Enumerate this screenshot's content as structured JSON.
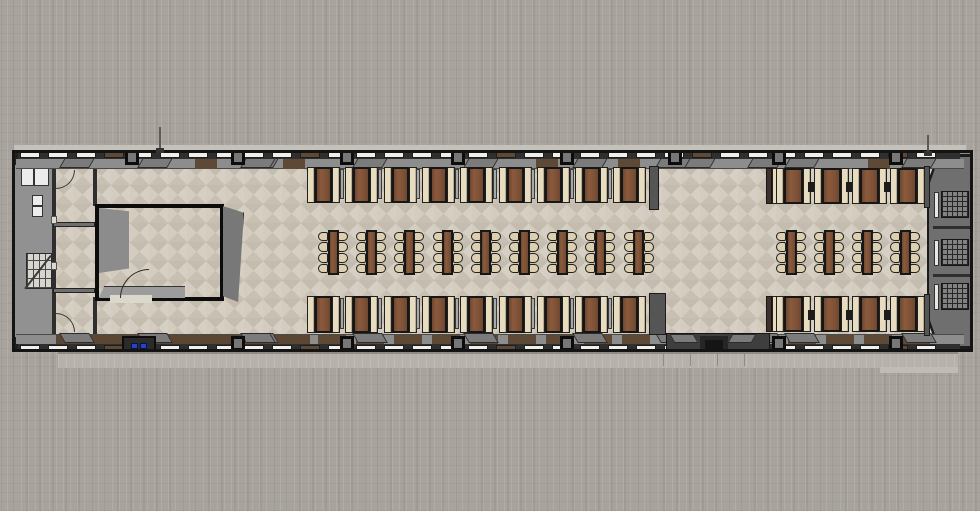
{
  "meta": {
    "width": 980,
    "height": 511,
    "scene": "top-down 3d floor plan render of a long railcar-style dining hall"
  },
  "colors": {
    "background": "#a8a49d",
    "platform": "#b6b2ab",
    "floor_light": "#d6d0c4",
    "floor_dark": "#c6bfb1",
    "wall_gray": "#8d8d8d",
    "wall_dark": "#2f2f2f",
    "frame_black": "#141414",
    "window_white": "#f1efe9",
    "wood_wall": "#5d4936",
    "table_brown": "#7e5237",
    "bench_cream": "#e7dcc0",
    "chair_cream": "#dccfb2",
    "left_cap_gray": "#919191",
    "right_cap_gray": "#6f6f6f",
    "stub_gray": "#555555",
    "trapezoid_gray": "#7b7b7b",
    "blue_fixture": "#2545c8",
    "roof_edge": "#c4c1ba"
  },
  "building": {
    "x": 12,
    "y": 150,
    "w": 961,
    "h": 202
  },
  "platform": {
    "x": 58,
    "y": 352,
    "w": 900,
    "h": 16,
    "tick_xs": [
      663,
      690,
      717,
      744
    ],
    "right_step": {
      "x": 880,
      "y": 367,
      "w": 78,
      "h": 6
    }
  },
  "floor": {
    "x": 54,
    "y": 166,
    "w": 878,
    "h": 170
  },
  "walls": {
    "window_row": {
      "start": 18,
      "end": 960,
      "step": 28,
      "seg_w": 20,
      "seg_h": 8,
      "top_y": 151,
      "bottom_y": 344,
      "brown_every": 7
    },
    "inner_band": {
      "top_y": 159,
      "bottom_y": 334,
      "h": 10
    },
    "boxes": {
      "xs": [
        125,
        231,
        340,
        451,
        560,
        668,
        772,
        889
      ],
      "w": 14,
      "h": 15,
      "top_y": 150,
      "bottom_y": 336
    },
    "trapezoid_extra_xs": [
      62,
      243,
      658,
      750
    ],
    "top_brown_segs": [
      195,
      283,
      536,
      618,
      868
    ],
    "bottom_brown_left_run": {
      "x": 56,
      "w": 254
    },
    "bottom_brown_seg_xs": [
      318,
      356,
      394,
      432,
      470,
      508,
      546,
      584,
      622,
      788,
      826,
      864,
      902
    ],
    "bottom_brown_seg_w": 28,
    "stubs": [
      [
        649,
        166,
        10,
        44
      ],
      [
        649,
        293,
        17,
        42
      ],
      [
        924,
        166,
        6,
        42
      ],
      [
        924,
        294,
        6,
        42
      ]
    ]
  },
  "gap_entry": {
    "base": {
      "x": 666,
      "y": 333,
      "w": 104,
      "h": 19
    },
    "recess": {
      "x": 700,
      "y": 336,
      "w": 28,
      "h": 15
    },
    "step": {
      "x": 705,
      "y": 340,
      "w": 18,
      "h": 9
    }
  },
  "left_end": {
    "cap": {
      "x": 15,
      "y": 153,
      "w": 39,
      "h": 196
    },
    "corner_blocks": [
      [
        15,
        153,
        12,
        12
      ],
      [
        15,
        337,
        12,
        12
      ]
    ],
    "cabinet": {
      "x": 21,
      "y": 168,
      "w": 28,
      "h": 18
    },
    "fixture": {
      "x": 32,
      "y": 195,
      "w": 11,
      "h": 22
    },
    "stairs": {
      "x": 26,
      "y": 253,
      "w": 26,
      "h": 36
    },
    "corridor_wall": {
      "x": 52,
      "y": 163,
      "w": 4,
      "h": 177
    },
    "partitions": [
      [
        53,
        222,
        42,
        5
      ],
      [
        53,
        288,
        42,
        5
      ]
    ],
    "jambs": [
      [
        51,
        216,
        6,
        8
      ],
      [
        51,
        262,
        6,
        8
      ]
    ],
    "door_arcs": {
      "top": {
        "x": 56,
        "y": 170,
        "r": 19
      },
      "bottom": {
        "x": 56,
        "y": 313,
        "r": 19
      }
    },
    "blue_box": {
      "x": 122,
      "y": 336,
      "w": 34,
      "h": 15
    },
    "blue_chips": [
      [
        131,
        343,
        7,
        6
      ],
      [
        140,
        343,
        7,
        6
      ]
    ],
    "vertical_partitions": [
      [
        93,
        166,
        4,
        40
      ],
      [
        93,
        297,
        4,
        38
      ]
    ]
  },
  "room": {
    "frame": {
      "x": 95,
      "y": 204,
      "w": 129,
      "h": 97
    },
    "left_panel": {
      "x": 99,
      "y": 208,
      "w": 30,
      "h": 65
    },
    "bottom_strip": {
      "x": 99,
      "y": 286,
      "w": 86,
      "h": 12
    },
    "door_gap": {
      "x": 110,
      "y": 295,
      "w": 42,
      "h": 8
    },
    "door_arc": {
      "x": 120,
      "y": 269,
      "r": 29
    },
    "extrusion": {
      "x": 223,
      "y": 206,
      "w": 21,
      "h": 96
    }
  },
  "right_end": {
    "cap_outer": {
      "x": 927,
      "y": 154,
      "w": 46,
      "h": 195
    },
    "cap_inner": {
      "x": 929,
      "y": 157,
      "w": 42,
      "h": 189
    },
    "white_strips_y": [
      192,
      240,
      284
    ],
    "grids_y": [
      191,
      239,
      283
    ],
    "grid": {
      "x": 941,
      "w": 28,
      "h": 27
    },
    "strip": {
      "x": 934,
      "w": 5,
      "h": 26
    },
    "dividers_y": [
      226,
      274
    ]
  },
  "antennas": [
    {
      "x": 159,
      "y": 127,
      "h": 25
    },
    {
      "x": 927,
      "y": 135,
      "h": 20
    }
  ],
  "furniture": {
    "booth_rows": [
      {
        "name": "middle-top",
        "x": 307,
        "y": 167,
        "count": 9,
        "dx": 38.3,
        "bench_w": 8,
        "table_w": 17,
        "h": 36,
        "separators": true,
        "lead_strip": false,
        "connectors": false
      },
      {
        "name": "middle-bottom",
        "x": 307,
        "y": 296,
        "count": 9,
        "dx": 38.3,
        "bench_w": 8,
        "table_w": 17,
        "h": 37,
        "separators": true,
        "lead_strip": false,
        "connectors": false
      },
      {
        "name": "right-top",
        "x": 776,
        "y": 168,
        "count": 4,
        "dx": 38,
        "bench_w": 8,
        "table_w": 19,
        "h": 36,
        "separators": false,
        "lead_strip": true,
        "connectors": true
      },
      {
        "name": "right-bottom",
        "x": 776,
        "y": 296,
        "count": 4,
        "dx": 38,
        "bench_w": 8,
        "table_w": 19,
        "h": 36,
        "separators": false,
        "lead_strip": true,
        "connectors": true
      }
    ],
    "table_clusters": [
      {
        "name": "middle",
        "x": 318,
        "y": 230,
        "count": 9,
        "dx": 38.2,
        "w": 30,
        "h": 45,
        "chairs_per_side": 4
      },
      {
        "name": "right",
        "x": 776,
        "y": 230,
        "count": 4,
        "dx": 38,
        "w": 30,
        "h": 45,
        "chairs_per_side": 4
      }
    ]
  }
}
